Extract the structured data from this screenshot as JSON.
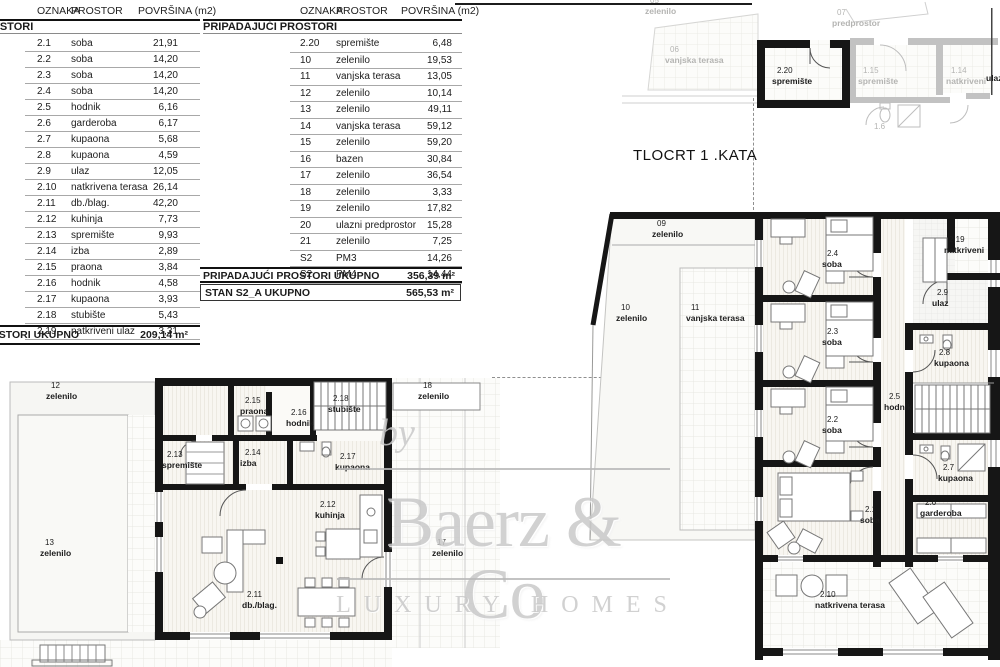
{
  "colors": {
    "wall": "#161616",
    "gray_plan": "#c2c2c2",
    "room_fill": "#f8f6f1",
    "grid_line": "#e7e7e3",
    "watermark": "#c9c9c9"
  },
  "tables": {
    "headers": {
      "col1": "OZNAKA",
      "col2": "PROSTOR",
      "col3": "POVRŠINA (m2)"
    },
    "left": {
      "section": "PROSTORI",
      "rows": [
        {
          "code": "2.1",
          "name": "soba",
          "area": "21,91"
        },
        {
          "code": "2.2",
          "name": "soba",
          "area": "14,20"
        },
        {
          "code": "2.3",
          "name": "soba",
          "area": "14,20"
        },
        {
          "code": "2.4",
          "name": "soba",
          "area": "14,20"
        },
        {
          "code": "2.5",
          "name": "hodnik",
          "area": "6,16"
        },
        {
          "code": "2.6",
          "name": "garderoba",
          "area": "6,17"
        },
        {
          "code": "2.7",
          "name": "kupaona",
          "area": "5,68"
        },
        {
          "code": "2.8",
          "name": "kupaona",
          "area": "4,59"
        },
        {
          "code": "2.9",
          "name": "ulaz",
          "area": "12,05"
        },
        {
          "code": "2.10",
          "name": "natkrivena terasa",
          "area": "26,14"
        },
        {
          "code": "2.11",
          "name": "db./blag.",
          "area": "42,20"
        },
        {
          "code": "2.12",
          "name": "kuhinja",
          "area": "7,73"
        },
        {
          "code": "2.13",
          "name": "spremište",
          "area": "9,93"
        },
        {
          "code": "2.14",
          "name": "izba",
          "area": "2,89"
        },
        {
          "code": "2.15",
          "name": "praona",
          "area": "3,84"
        },
        {
          "code": "2.16",
          "name": "hodnik",
          "area": "4,58"
        },
        {
          "code": "2.17",
          "name": "kupaona",
          "area": "3,93"
        },
        {
          "code": "2.18",
          "name": "stubište",
          "area": "5,43"
        },
        {
          "code": "2.19",
          "name": "natkriveni ulaz",
          "area": "3,31"
        }
      ],
      "total_label": "PROSTORI UKUPNO",
      "total_value": "209,14 m²"
    },
    "mid": {
      "section": "PRIPADAJUĆI PROSTORI",
      "rows": [
        {
          "code": "2.20",
          "name": "spremište",
          "area": "6,48"
        },
        {
          "code": "10",
          "name": "zelenilo",
          "area": "19,53"
        },
        {
          "code": "11",
          "name": "vanjska terasa",
          "area": "13,05"
        },
        {
          "code": "12",
          "name": "zelenilo",
          "area": "10,14"
        },
        {
          "code": "13",
          "name": "zelenilo",
          "area": "49,11"
        },
        {
          "code": "14",
          "name": "vanjska terasa",
          "area": "59,12"
        },
        {
          "code": "15",
          "name": "zelenilo",
          "area": "59,20"
        },
        {
          "code": "16",
          "name": "bazen",
          "area": "30,84"
        },
        {
          "code": "17",
          "name": "zelenilo",
          "area": "36,54"
        },
        {
          "code": "18",
          "name": "zelenilo",
          "area": "3,33"
        },
        {
          "code": "19",
          "name": "zelenilo",
          "area": "17,82"
        },
        {
          "code": "20",
          "name": "ulazni predprostor",
          "area": "15,28"
        },
        {
          "code": "21",
          "name": "zelenilo",
          "area": "7,25"
        },
        {
          "code": "S2",
          "name": "PM3",
          "area": "14,26"
        },
        {
          "code": "S2",
          "name": "PM4",
          "area": "14,44"
        }
      ],
      "subtotal_label": "PRIPADAJUĆI PROSTORI UKUPNO",
      "subtotal_value": "356,39 m²",
      "total_label": "STAN S2_A UKUPNO",
      "total_value": "565,53 m²"
    }
  },
  "plan_title": "TLOCRT 1 .KATA",
  "watermark": {
    "by": "by",
    "brand": "Baerz & Co",
    "tagline": "LUXURY HOMES"
  },
  "labels": {
    "top_fragment": [
      {
        "code": "05",
        "name": "zelenilo"
      },
      {
        "code": "06",
        "name": "vanjska terasa"
      },
      {
        "code": "07",
        "name": "predprostor"
      },
      {
        "code": "2.20",
        "name": "spremište"
      },
      {
        "code": "1.15",
        "name": "spremište"
      },
      {
        "code": "1.14",
        "name": "natkriveni"
      },
      {
        "code": "",
        "name": "ulaz"
      },
      {
        "code": "1.6",
        "name": ""
      }
    ],
    "right_plan": [
      {
        "code": "09",
        "name": "zelenilo"
      },
      {
        "code": "10",
        "name": "zelenilo"
      },
      {
        "code": "11",
        "name": "vanjska terasa"
      },
      {
        "code": "2.4",
        "name": "soba"
      },
      {
        "code": "2.3",
        "name": "soba"
      },
      {
        "code": "2.2",
        "name": "soba"
      },
      {
        "code": "2.1",
        "name": "soba"
      },
      {
        "code": "2.9",
        "name": "ulaz"
      },
      {
        "code": "2.19",
        "name": "natkriveni"
      },
      {
        "code": "2.8",
        "name": "kupaona"
      },
      {
        "code": "2.5",
        "name": "hodnik"
      },
      {
        "code": "2.7",
        "name": "kupaona"
      },
      {
        "code": "2.6",
        "name": "garderoba"
      },
      {
        "code": "2.10",
        "name": "natkrivena terasa"
      }
    ],
    "left_plan": [
      {
        "code": "12",
        "name": "zelenilo"
      },
      {
        "code": "13",
        "name": "zelenilo"
      },
      {
        "code": "18",
        "name": "zelenilo"
      },
      {
        "code": "17",
        "name": "zelenilo"
      },
      {
        "code": "2.15",
        "name": "praona"
      },
      {
        "code": "2.16",
        "name": "hodnik"
      },
      {
        "code": "2.18",
        "name": "stubište"
      },
      {
        "code": "2.13",
        "name": "spremište"
      },
      {
        "code": "2.14",
        "name": "izba"
      },
      {
        "code": "2.17",
        "name": "kupaona"
      },
      {
        "code": "2.12",
        "name": "kuhinja"
      },
      {
        "code": "2.11",
        "name": "db./blag."
      }
    ]
  }
}
